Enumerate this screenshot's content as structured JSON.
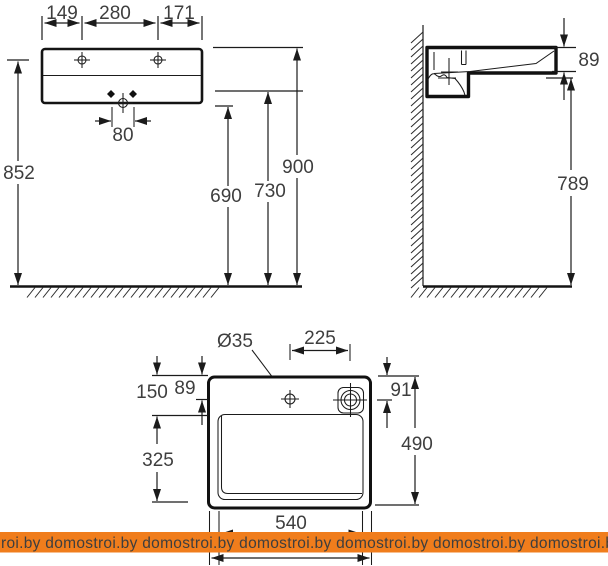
{
  "front_view": {
    "dim_top_left": "149",
    "dim_top_mid": "280",
    "dim_top_right": "171",
    "dim_hole_spacing": "80",
    "dim_height_holes": "852",
    "dim_height_690": "690",
    "dim_height_730": "730",
    "dim_height_900": "900"
  },
  "side_view": {
    "dim_rim": "89",
    "dim_height_789": "789"
  },
  "plan_view": {
    "dim_faucet_dia": "Ø35",
    "dim_faucet_to_drain": "225",
    "dim_150": "150",
    "dim_89": "89",
    "dim_91": "91",
    "dim_490": "490",
    "dim_325": "325",
    "dim_540": "540"
  },
  "watermark": {
    "band_color": "#f07d1c",
    "text_color": "#ffffff",
    "text": "roi.by  domostroi.by  domostroi.by  domostroi.by  domostroi.by  domostroi.by  domostroi.by"
  }
}
